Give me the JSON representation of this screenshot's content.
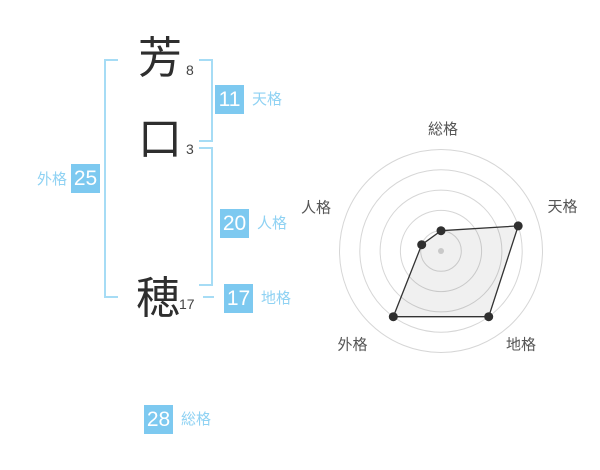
{
  "name": {
    "characters": [
      {
        "char": "芳",
        "strokes": "8"
      },
      {
        "char": "口",
        "strokes": "3"
      },
      {
        "char": "穂",
        "strokes": "17"
      }
    ]
  },
  "categories": {
    "tenkaku": {
      "label": "天格",
      "value": "11"
    },
    "jinkaku": {
      "label": "人格",
      "value": "20"
    },
    "chikaku": {
      "label": "地格",
      "value": "17"
    },
    "gaikaku": {
      "label": "外格",
      "value": "25"
    },
    "soukaku": {
      "label": "総格",
      "value": "28"
    }
  },
  "chart_data": {
    "type": "radar",
    "axes": [
      "総格",
      "天格",
      "地格",
      "外格",
      "人格"
    ],
    "values": [
      1,
      4,
      4,
      4,
      1
    ],
    "scale_max": 5,
    "rings": 5,
    "start_angle": "top",
    "direction": "clockwise",
    "grid": "concentric-circles",
    "legend": "none"
  },
  "colors": {
    "accent_box": "#7DC9F0",
    "accent_label": "#8FD2F3",
    "bracket": "#A6DCF5",
    "kanji": "#2E2E2E",
    "radar_ring": "#D6D6D6",
    "radar_line": "#333333",
    "radar_point": "#2F2F2F",
    "radar_center_dot": "#C9C9C9",
    "radar_fill": "rgba(0,0,0,0.06)",
    "radar_label": "#555555"
  }
}
